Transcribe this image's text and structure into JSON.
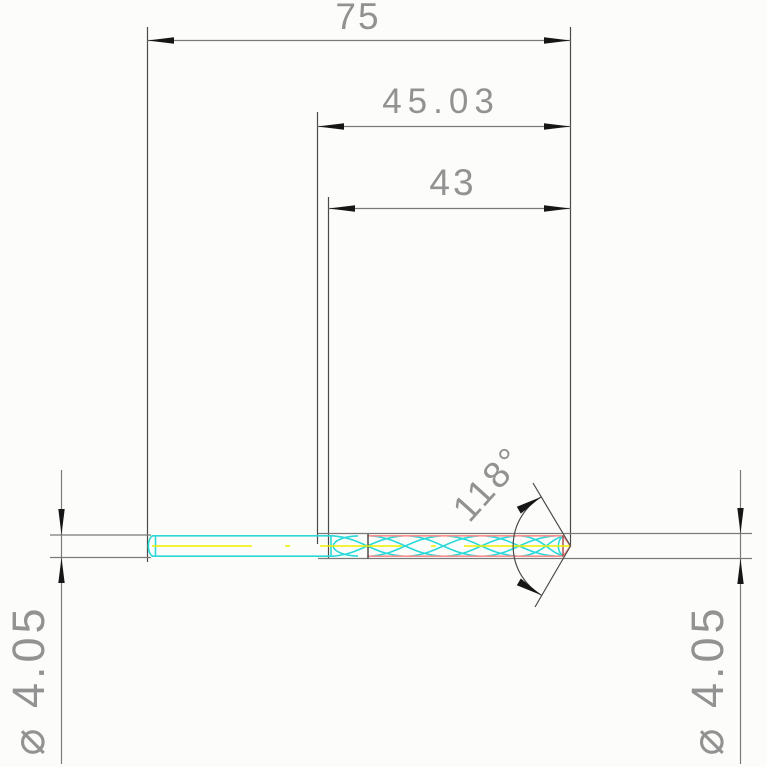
{
  "drawing": {
    "background": "#fcfdfa",
    "labels": {
      "overall_length": "75",
      "intermediate_length": "45.03",
      "flute_length": "43",
      "point_angle": "118°",
      "diameter_left": "⌀ 4.05",
      "diameter_right": "⌀ 4.05"
    },
    "colors": {
      "dimension_line": "#7a7a7a",
      "extension_line": "#4a4a4a",
      "dimension_text": "#929292",
      "arrowhead": "#161616",
      "shank_outline": "#2bd9d9",
      "flute_outline": "#ff9090",
      "centerline": "#f0f000",
      "tip_edge": "#a34848",
      "feature_line": "#3f3f3f"
    }
  }
}
